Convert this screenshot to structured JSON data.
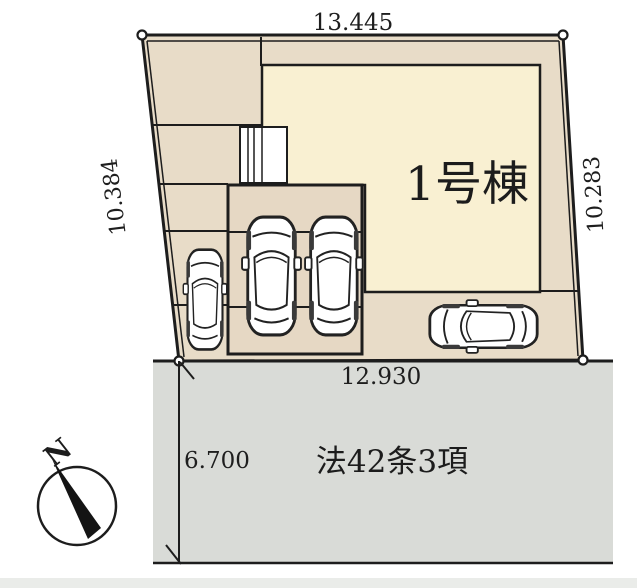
{
  "site_plan": {
    "building": {
      "label": "1号棟"
    },
    "road": {
      "label": "法42条3項",
      "width_dim": "6.700",
      "frontage_dim": "12.930"
    },
    "boundary_dims": {
      "top": "13.445",
      "left": "10.384",
      "right": "10.283"
    },
    "compass": {
      "north_label": "N"
    },
    "colors": {
      "lot_fill": "#e8dcc8",
      "building_fill": "#f9f0d2",
      "garage_fill": "#e6d8c4",
      "porch_fill": "#ffffff",
      "road_fill": "#d9dbd7",
      "line": "#1d1d1d"
    },
    "cars_count": 4
  }
}
